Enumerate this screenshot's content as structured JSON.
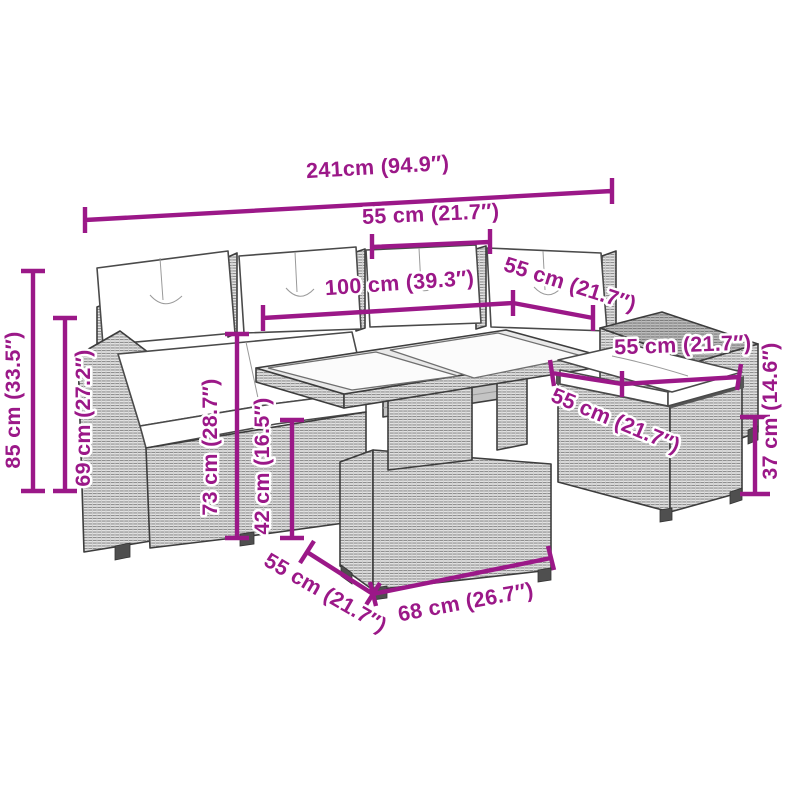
{
  "figure_alt": "Technical line drawing of a poly rattan garden lounge set: corner sofa with white cushions, glass-top table and two footstools, annotated with magenta dimension lines",
  "accent_color": "#9B1888",
  "line_art_color": "#3d3d3d",
  "background_color": "#ffffff",
  "measurements": [
    {
      "id": "overall-width",
      "label": "241cm (94.9″)"
    },
    {
      "id": "backrest-width",
      "label": "55 cm (21.7″)"
    },
    {
      "id": "table-length",
      "label": "100 cm (39.3″)"
    },
    {
      "id": "table-depth",
      "label": "55 cm (21.7″)"
    },
    {
      "id": "stool-width",
      "label": "55 cm (21.7″)"
    },
    {
      "id": "stool-depth",
      "label": "55 cm (21.7″)"
    },
    {
      "id": "stool-height",
      "label": "37 cm (14.6″)"
    },
    {
      "id": "sofa-height",
      "label": "85 cm (33.5″)"
    },
    {
      "id": "armrest-height",
      "label": "69 cm (27.2″)"
    },
    {
      "id": "table-height",
      "label": "73 cm (28.7″)"
    },
    {
      "id": "table-base-height",
      "label": "42 cm (16.5″)"
    },
    {
      "id": "table-base-depth",
      "label": "55 cm (21.7″)"
    },
    {
      "id": "table-base-width",
      "label": "68 cm (26.7″)"
    }
  ]
}
